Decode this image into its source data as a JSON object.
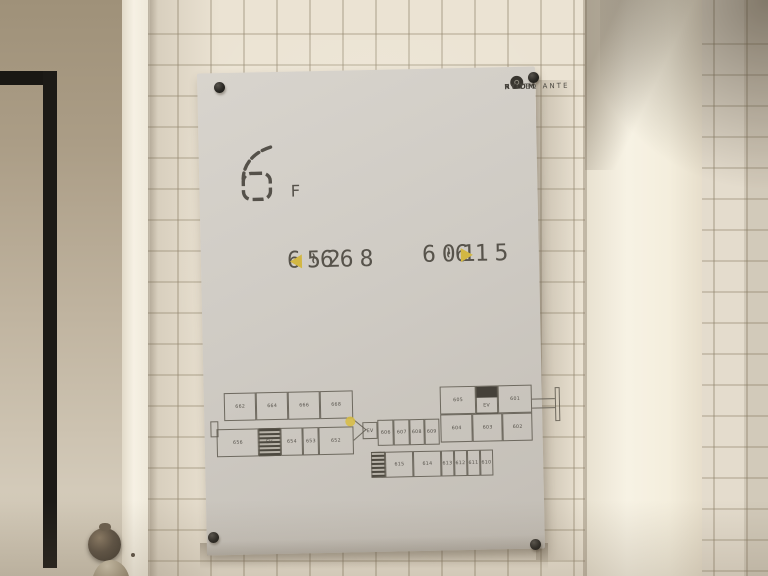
{
  "poster": {
    "logo": {
      "part1": "HOTEL ANTE",
      "part2": "ROOM",
      "part3": " KYOTO"
    },
    "floor": {
      "number": "6",
      "suffix": "F"
    },
    "ranges": {
      "left": {
        "from": "652",
        "tilde": "~",
        "to": "668"
      },
      "right": {
        "from": "601",
        "tilde": "~",
        "to": "615"
      }
    },
    "accent_color": "#d2b743",
    "text_color": "#57534b"
  },
  "floorplan": {
    "elevator_label": "EV",
    "left_wing_top": [
      "662",
      "664",
      "666",
      "668"
    ],
    "left_wing_bottom": [
      "656",
      "654",
      "653",
      "652"
    ],
    "mid_top": [
      "606",
      "607",
      "608",
      "609"
    ],
    "mid_bottom": [
      "615",
      "614",
      "613",
      "612",
      "611",
      "610"
    ],
    "right_top": [
      "605",
      "601"
    ],
    "right_bottom": [
      "604",
      "603",
      "602"
    ]
  }
}
